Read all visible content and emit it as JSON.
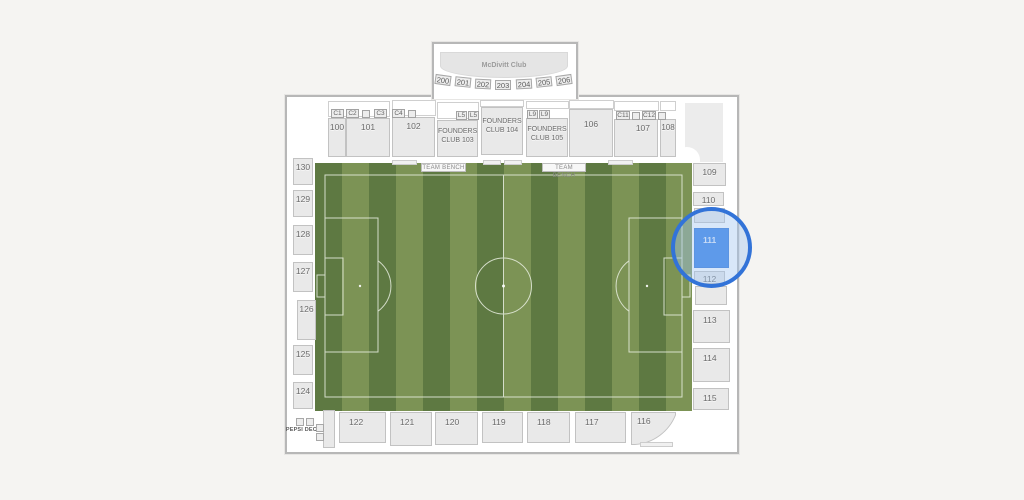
{
  "page": {
    "background": "#f5f4f2"
  },
  "stadium": {
    "club_label": "McDivitt Club",
    "upper_sections": [
      "200",
      "201",
      "202",
      "203",
      "204",
      "205",
      "206"
    ],
    "suite_boxes": [
      "C1",
      "C2",
      "C3",
      "C4",
      "L5",
      "L5",
      "L9",
      "L9",
      "C11",
      "C12"
    ],
    "top_sections": [
      "100",
      "101",
      "102",
      "FOUNDERS CLUB 103",
      "FOUNDERS CLUB 104",
      "FOUNDERS CLUB 105",
      "106",
      "107",
      "108"
    ],
    "left_sections": [
      "130",
      "129",
      "128",
      "127",
      "126",
      "125",
      "124"
    ],
    "right_sections": [
      "109",
      "110",
      "111",
      "112",
      "113",
      "114",
      "115"
    ],
    "bottom_sections": [
      "122",
      "121",
      "120",
      "119",
      "118",
      "117",
      "116"
    ],
    "labels": {
      "team_bench": "TEAM BENCH",
      "pepsi_deck": "PEPSI DECK"
    },
    "selection": {
      "section": "111",
      "fill": "#2d7ae5",
      "ring_color": "#3273d8"
    },
    "field": {
      "stripe_dark": "#5e7942",
      "stripe_light": "#7c9355",
      "line_color": "#e9efe1"
    }
  }
}
